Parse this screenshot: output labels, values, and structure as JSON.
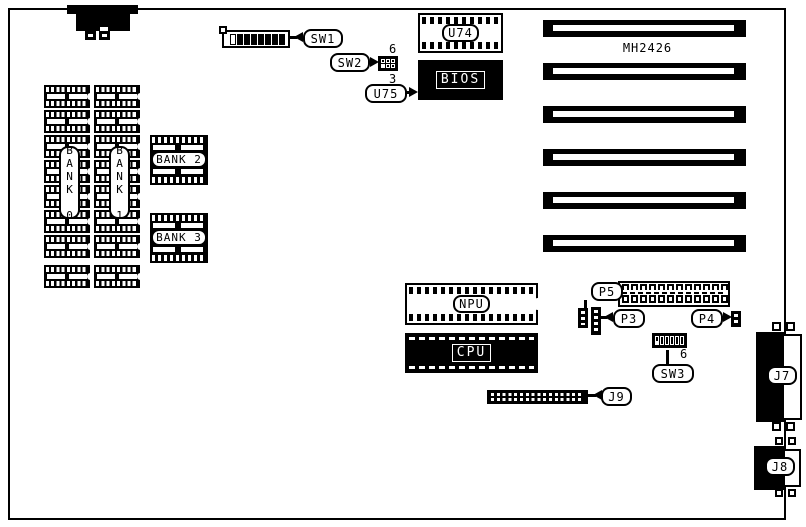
{
  "board": {
    "model": "MH2426"
  },
  "memory": {
    "bank0_label": "BANK 0",
    "bank1_label": "BANK 1",
    "bank2_label": "BANK 2",
    "bank3_label": "BANK 3",
    "chips_per_column": 8
  },
  "chips": {
    "u74": "U74",
    "bios": "BIOS",
    "bios_designator": "U75",
    "npu": "NPU",
    "cpu": "CPU"
  },
  "switches": {
    "sw1": {
      "label": "SW1",
      "positions": 8
    },
    "sw2": {
      "label": "SW2",
      "positions": 6,
      "rows": 2,
      "cols": 3,
      "pin_top": "6",
      "pin_bottom": "3"
    },
    "sw3": {
      "label": "SW3",
      "positions": 6,
      "pin": "6"
    }
  },
  "connectors": {
    "p3": "P3",
    "p4": "P4",
    "p5": "P5",
    "j7": "J7",
    "j8": "J8",
    "j9": "J9",
    "p5_pins": 12,
    "j9_pin_columns": 17
  },
  "slots": {
    "count": 6
  },
  "colors": {
    "ink": "#000000",
    "paper": "#ffffff"
  }
}
